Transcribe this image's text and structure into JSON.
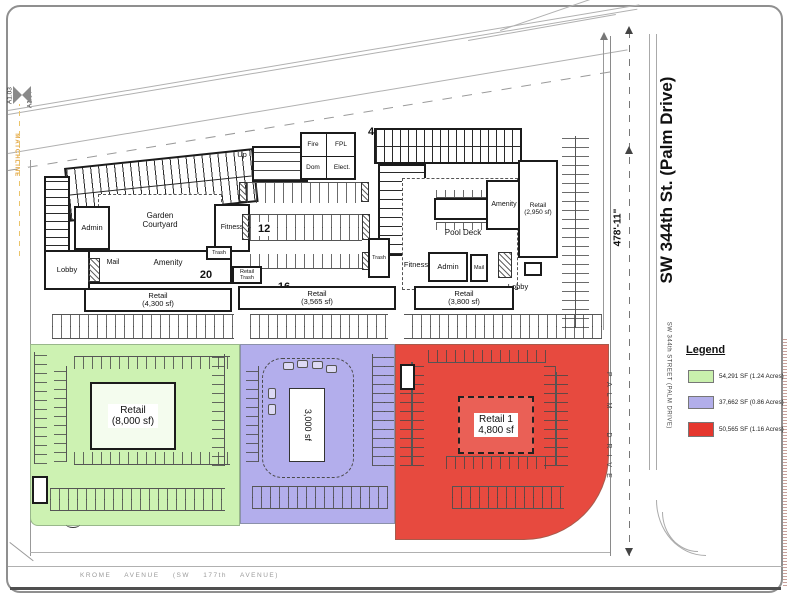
{
  "roads": {
    "palm_main": "SW 344th St. (Palm Drive)",
    "palm_small": "SW 344th STREET (PALM DRIVE)",
    "palm_stacked": "PALM DRIVE",
    "krome": "KROME AVENUE (SW 177th AVENUE)",
    "dimension": "478'-11\""
  },
  "matchline": {
    "sheet_left": "A1.03",
    "sheet_right": "A1.04",
    "label": "MATCHLINE"
  },
  "legend": {
    "title": "Legend",
    "items": [
      {
        "color": "#c9f0ad",
        "label": "54,291 SF (1.24 Acres)"
      },
      {
        "color": "#b2aeea",
        "label": "37,662 SF (0.86 Acres)"
      },
      {
        "color": "#e5372e",
        "label": "50,565 SF (1.16 Acres)"
      }
    ]
  },
  "left_building": {
    "admin": "Admin",
    "garden_line1": "Garden",
    "garden_line2": "Courtyard",
    "fitness": "Fitness",
    "lobby": "Lobby",
    "mail": "Mail",
    "amenity": "Amenity",
    "trash": "Trash",
    "retail_line1": "Retail",
    "retail_line2": "(4,300 sf)",
    "unit_count": "20"
  },
  "center_block": {
    "up": "Up",
    "fire": "Fire",
    "fpl": "FPL",
    "dom": "Dom",
    "elect": "Elect.",
    "stall_count": "12",
    "retail_trash_line1": "Retail",
    "retail_trash_line2": "Trash",
    "unit_count": "16",
    "retail_line1": "Retail",
    "retail_line2": "(3,565 sf)"
  },
  "right_building": {
    "unit_count": "4",
    "pool_deck": "Pool Deck",
    "amenity": "Amenity",
    "retail_east_line1": "Retail",
    "retail_east_line2": "(2,950 sf)",
    "trash": "Trash",
    "fitness": "Fitness",
    "admin": "Admin",
    "mail": "Mail",
    "lobby": "Lobby",
    "retail_line1": "Retail",
    "retail_line2": "(3,800 sf)"
  },
  "outparcels": {
    "green": {
      "color": "#cdf2b2",
      "line1": "Retail",
      "line2": "(8,000 sf)"
    },
    "purple": {
      "color": "#b3aeec",
      "label": "3,000 sf"
    },
    "red": {
      "color": "#e74a3f",
      "line1": "Retail 1",
      "line2": "4,800 sf"
    }
  }
}
